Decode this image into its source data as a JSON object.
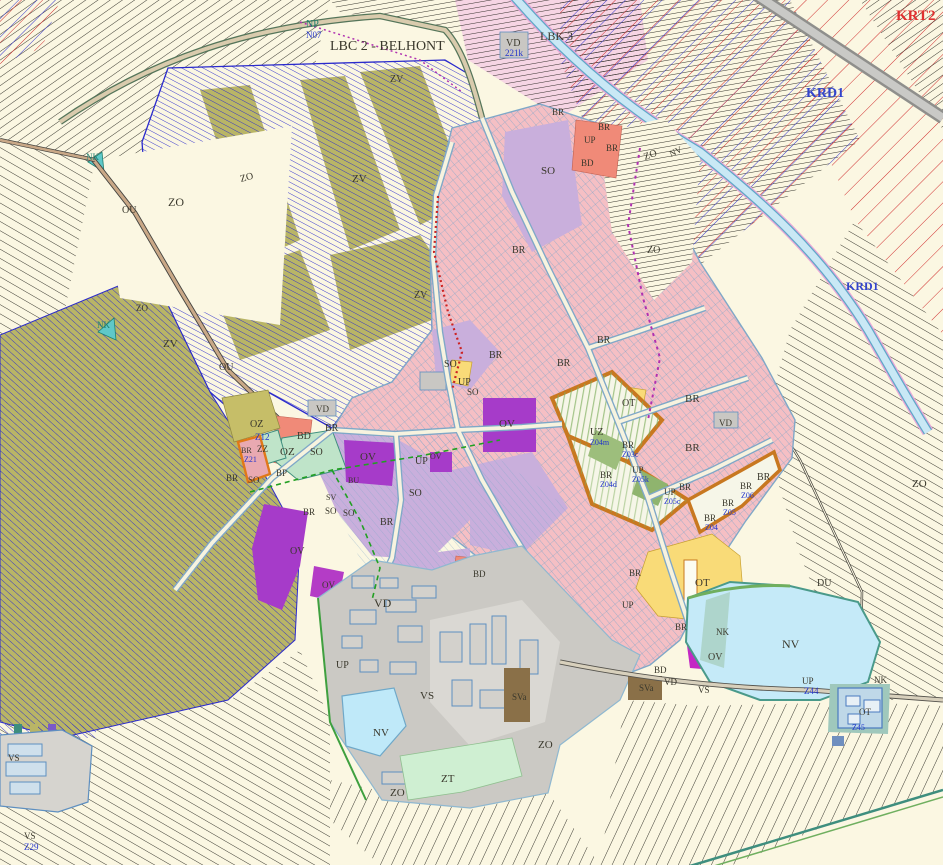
{
  "map": {
    "type": "zoning-plan",
    "palette": {
      "background": "#FBF7E2",
      "field_line": "#26241C",
      "agri_blue": "#2A2ACC",
      "olive": "#B9B566",
      "town_pink": "#F5BFC4",
      "parcel_blue": "#7FA6C8",
      "lavender_so": "#C9AFDC",
      "purple_ov": "#A63BC9",
      "magenta_ov": "#C428C4",
      "salmon_bd": "#F08A78",
      "yellow_ot": "#F9DB78",
      "orange_uz": "#C87820",
      "gray_vd": "#CBC9C4",
      "gray_vs": "#DAD8D3",
      "building_blue": "#5E8FC0",
      "water": "#C5EAF8",
      "water_edge": "#4A9A8A",
      "green_zt": "#CFEFD2",
      "mint_oz": "#BFE4C9",
      "brown_sva": "#8A7048",
      "red_hatch": "#D03030",
      "canal_pink_edge": "#E8A8D8",
      "label_black": "#3A382C",
      "label_blue": "#2233CC",
      "label_teal": "#1E8070",
      "label_red": "#E03030",
      "label_krd_blue": "#3344CC"
    },
    "labels": [
      {
        "t": "NP",
        "x": 306,
        "y": 27,
        "c": "teal",
        "s": 10
      },
      {
        "t": "N07",
        "x": 306,
        "y": 38,
        "c": "blue",
        "s": 9
      },
      {
        "t": "LBC 2 - BELHONT",
        "x": 330,
        "y": 50,
        "c": "black",
        "s": 14
      },
      {
        "t": "LBK 3",
        "x": 540,
        "y": 40,
        "c": "black",
        "s": 12
      },
      {
        "t": "KRT2",
        "x": 896,
        "y": 20,
        "c": "red",
        "s": 15
      },
      {
        "t": "KRD1",
        "x": 806,
        "y": 97,
        "c": "bluebig",
        "s": 14
      },
      {
        "t": "KRD1",
        "x": 846,
        "y": 290,
        "c": "bluebig",
        "s": 12
      },
      {
        "t": "VD",
        "x": 506,
        "y": 46,
        "c": "black",
        "s": 10
      },
      {
        "t": "221k",
        "x": 505,
        "y": 56,
        "c": "blue",
        "s": 9
      },
      {
        "t": "ZO",
        "x": 168,
        "y": 206,
        "c": "black",
        "s": 12
      },
      {
        "t": "OU",
        "x": 122,
        "y": 213,
        "c": "black",
        "s": 10
      },
      {
        "t": "ZO",
        "x": 241,
        "y": 182,
        "c": "black",
        "s": 10,
        "r": -15
      },
      {
        "t": "ZV",
        "x": 352,
        "y": 182,
        "c": "black",
        "s": 11
      },
      {
        "t": "ZV",
        "x": 390,
        "y": 82,
        "c": "black",
        "s": 10
      },
      {
        "t": "ZV",
        "x": 414,
        "y": 298,
        "c": "black",
        "s": 10
      },
      {
        "t": "ZV",
        "x": 163,
        "y": 347,
        "c": "black",
        "s": 11
      },
      {
        "t": "NK",
        "x": 97,
        "y": 328,
        "c": "teal",
        "s": 9
      },
      {
        "t": "NK",
        "x": 86,
        "y": 160,
        "c": "teal",
        "s": 9
      },
      {
        "t": "ZO",
        "x": 136,
        "y": 311,
        "c": "black",
        "s": 9
      },
      {
        "t": "OU",
        "x": 219,
        "y": 370,
        "c": "black",
        "s": 10
      },
      {
        "t": "ZO",
        "x": 538,
        "y": 748,
        "c": "black",
        "s": 11
      },
      {
        "t": "ZO",
        "x": 390,
        "y": 796,
        "c": "black",
        "s": 11
      },
      {
        "t": "ZT",
        "x": 441,
        "y": 782,
        "c": "black",
        "s": 11
      },
      {
        "t": "ZO",
        "x": 912,
        "y": 487,
        "c": "black",
        "s": 11
      },
      {
        "t": "VS",
        "x": 420,
        "y": 699,
        "c": "black",
        "s": 11
      },
      {
        "t": "VD",
        "x": 374,
        "y": 607,
        "c": "black",
        "s": 12
      },
      {
        "t": "NV",
        "x": 373,
        "y": 736,
        "c": "black",
        "s": 11
      },
      {
        "t": "UP",
        "x": 336,
        "y": 668,
        "c": "black",
        "s": 10
      },
      {
        "t": "SVa",
        "x": 512,
        "y": 700,
        "c": "black",
        "s": 9
      },
      {
        "t": "SVa",
        "x": 639,
        "y": 691,
        "c": "black",
        "s": 9
      },
      {
        "t": "VD",
        "x": 664,
        "y": 685,
        "c": "black",
        "s": 9
      },
      {
        "t": "VS",
        "x": 698,
        "y": 693,
        "c": "black",
        "s": 9
      },
      {
        "t": "NV",
        "x": 782,
        "y": 648,
        "c": "black",
        "s": 12
      },
      {
        "t": "NK",
        "x": 716,
        "y": 635,
        "c": "black",
        "s": 9
      },
      {
        "t": "OT",
        "x": 695,
        "y": 586,
        "c": "black",
        "s": 11
      },
      {
        "t": "DU",
        "x": 817,
        "y": 586,
        "c": "black",
        "s": 10
      },
      {
        "t": "UP",
        "x": 802,
        "y": 684,
        "c": "black",
        "s": 9
      },
      {
        "t": "Z44",
        "x": 804,
        "y": 694,
        "c": "blue",
        "s": 9
      },
      {
        "t": "OV",
        "x": 708,
        "y": 660,
        "c": "black",
        "s": 10
      },
      {
        "t": "BR",
        "x": 629,
        "y": 576,
        "c": "black",
        "s": 9
      },
      {
        "t": "UP",
        "x": 622,
        "y": 608,
        "c": "black",
        "s": 9
      },
      {
        "t": "BR",
        "x": 675,
        "y": 630,
        "c": "black",
        "s": 9
      },
      {
        "t": "BD",
        "x": 654,
        "y": 673,
        "c": "black",
        "s": 9
      },
      {
        "t": "NK",
        "x": 874,
        "y": 683,
        "c": "black",
        "s": 9
      },
      {
        "t": "OT",
        "x": 859,
        "y": 715,
        "c": "black",
        "s": 9
      },
      {
        "t": "Z45",
        "x": 852,
        "y": 730,
        "c": "blue",
        "s": 8
      },
      {
        "t": "VS",
        "x": 8,
        "y": 761,
        "c": "black",
        "s": 9
      },
      {
        "t": "VS",
        "x": 24,
        "y": 839,
        "c": "black",
        "s": 9
      },
      {
        "t": "Z29",
        "x": 24,
        "y": 850,
        "c": "blue",
        "s": 9
      },
      {
        "t": "OZ",
        "x": 250,
        "y": 427,
        "c": "black",
        "s": 10
      },
      {
        "t": "Z12",
        "x": 255,
        "y": 440,
        "c": "blue",
        "s": 9
      },
      {
        "t": "ZZ",
        "x": 257,
        "y": 452,
        "c": "black",
        "s": 9
      },
      {
        "t": "OZ",
        "x": 280,
        "y": 455,
        "c": "black",
        "s": 11
      },
      {
        "t": "BR",
        "x": 241,
        "y": 453,
        "c": "black",
        "s": 8
      },
      {
        "t": "Z21",
        "x": 244,
        "y": 462,
        "c": "blue",
        "s": 8
      },
      {
        "t": "BP",
        "x": 276,
        "y": 476,
        "c": "black",
        "s": 9
      },
      {
        "t": "BD",
        "x": 297,
        "y": 439,
        "c": "black",
        "s": 10
      },
      {
        "t": "BR",
        "x": 325,
        "y": 431,
        "c": "black",
        "s": 10
      },
      {
        "t": "SO",
        "x": 310,
        "y": 455,
        "c": "black",
        "s": 10
      },
      {
        "t": "BR",
        "x": 226,
        "y": 481,
        "c": "black",
        "s": 9
      },
      {
        "t": "SO",
        "x": 248,
        "y": 483,
        "c": "black",
        "s": 9
      },
      {
        "t": "VD",
        "x": 316,
        "y": 412,
        "c": "black",
        "s": 9
      },
      {
        "t": "OV",
        "x": 360,
        "y": 460,
        "c": "black",
        "s": 11
      },
      {
        "t": "UP",
        "x": 415,
        "y": 464,
        "c": "black",
        "s": 10
      },
      {
        "t": "SO",
        "x": 409,
        "y": 496,
        "c": "black",
        "s": 10
      },
      {
        "t": "BR",
        "x": 303,
        "y": 515,
        "c": "black",
        "s": 9
      },
      {
        "t": "SO",
        "x": 325,
        "y": 514,
        "c": "black",
        "s": 9
      },
      {
        "t": "SO",
        "x": 343,
        "y": 516,
        "c": "black",
        "s": 9
      },
      {
        "t": "BR",
        "x": 380,
        "y": 525,
        "c": "black",
        "s": 10
      },
      {
        "t": "SV",
        "x": 326,
        "y": 500,
        "c": "black",
        "s": 8
      },
      {
        "t": "BU",
        "x": 348,
        "y": 483,
        "c": "black",
        "s": 8
      },
      {
        "t": "SO",
        "x": 444,
        "y": 367,
        "c": "black",
        "s": 10
      },
      {
        "t": "UP",
        "x": 458,
        "y": 385,
        "c": "black",
        "s": 10
      },
      {
        "t": "BR",
        "x": 489,
        "y": 358,
        "c": "black",
        "s": 10
      },
      {
        "t": "BR",
        "x": 557,
        "y": 366,
        "c": "black",
        "s": 10
      },
      {
        "t": "OV",
        "x": 499,
        "y": 427,
        "c": "black",
        "s": 11
      },
      {
        "t": "SO",
        "x": 467,
        "y": 395,
        "c": "black",
        "s": 9
      },
      {
        "t": "OV",
        "x": 430,
        "y": 459,
        "c": "black",
        "s": 8
      },
      {
        "t": "SO",
        "x": 541,
        "y": 174,
        "c": "black",
        "s": 11
      },
      {
        "t": "BR",
        "x": 598,
        "y": 130,
        "c": "black",
        "s": 9
      },
      {
        "t": "UP",
        "x": 584,
        "y": 143,
        "c": "black",
        "s": 9
      },
      {
        "t": "BR",
        "x": 606,
        "y": 151,
        "c": "black",
        "s": 9
      },
      {
        "t": "BD",
        "x": 581,
        "y": 166,
        "c": "black",
        "s": 9
      },
      {
        "t": "BR",
        "x": 552,
        "y": 115,
        "c": "black",
        "s": 9
      },
      {
        "t": "ZO",
        "x": 645,
        "y": 160,
        "c": "black",
        "s": 10,
        "r": -20
      },
      {
        "t": "NV",
        "x": 671,
        "y": 157,
        "c": "black",
        "s": 9,
        "r": -25
      },
      {
        "t": "ZO",
        "x": 647,
        "y": 253,
        "c": "black",
        "s": 10
      },
      {
        "t": "BR",
        "x": 512,
        "y": 253,
        "c": "black",
        "s": 10
      },
      {
        "t": "BR",
        "x": 597,
        "y": 343,
        "c": "black",
        "s": 10
      },
      {
        "t": "BR",
        "x": 685,
        "y": 402,
        "c": "black",
        "s": 11
      },
      {
        "t": "BR",
        "x": 685,
        "y": 451,
        "c": "black",
        "s": 11
      },
      {
        "t": "OT",
        "x": 622,
        "y": 406,
        "c": "black",
        "s": 10
      },
      {
        "t": "UZ",
        "x": 590,
        "y": 435,
        "c": "black",
        "s": 10
      },
      {
        "t": "Z04m",
        "x": 590,
        "y": 445,
        "c": "blue",
        "s": 8
      },
      {
        "t": "BR",
        "x": 622,
        "y": 448,
        "c": "black",
        "s": 9
      },
      {
        "t": "Z03c",
        "x": 622,
        "y": 457,
        "c": "blue",
        "s": 8
      },
      {
        "t": "BR",
        "x": 600,
        "y": 478,
        "c": "black",
        "s": 9
      },
      {
        "t": "Z04d",
        "x": 600,
        "y": 487,
        "c": "blue",
        "s": 8
      },
      {
        "t": "UP",
        "x": 632,
        "y": 473,
        "c": "black",
        "s": 9
      },
      {
        "t": "Z05k",
        "x": 632,
        "y": 482,
        "c": "blue",
        "s": 8
      },
      {
        "t": "UP",
        "x": 664,
        "y": 495,
        "c": "black",
        "s": 9
      },
      {
        "t": "Z05c",
        "x": 664,
        "y": 504,
        "c": "blue",
        "s": 8
      },
      {
        "t": "BR",
        "x": 679,
        "y": 490,
        "c": "black",
        "s": 9
      },
      {
        "t": "BR",
        "x": 757,
        "y": 480,
        "c": "black",
        "s": 10
      },
      {
        "t": "BR",
        "x": 740,
        "y": 489,
        "c": "black",
        "s": 9
      },
      {
        "t": "Z06",
        "x": 741,
        "y": 498,
        "c": "blue",
        "s": 8
      },
      {
        "t": "BR",
        "x": 722,
        "y": 506,
        "c": "black",
        "s": 9
      },
      {
        "t": "Z05",
        "x": 723,
        "y": 515,
        "c": "blue",
        "s": 8
      },
      {
        "t": "BR",
        "x": 704,
        "y": 521,
        "c": "black",
        "s": 9
      },
      {
        "t": "Z04",
        "x": 705,
        "y": 530,
        "c": "blue",
        "s": 8
      },
      {
        "t": "VD",
        "x": 719,
        "y": 426,
        "c": "black",
        "s": 9
      },
      {
        "t": "OV",
        "x": 322,
        "y": 588,
        "c": "black",
        "s": 9
      },
      {
        "t": "OV",
        "x": 290,
        "y": 554,
        "c": "black",
        "s": 10
      },
      {
        "t": "BD",
        "x": 473,
        "y": 577,
        "c": "black",
        "s": 9
      }
    ]
  }
}
